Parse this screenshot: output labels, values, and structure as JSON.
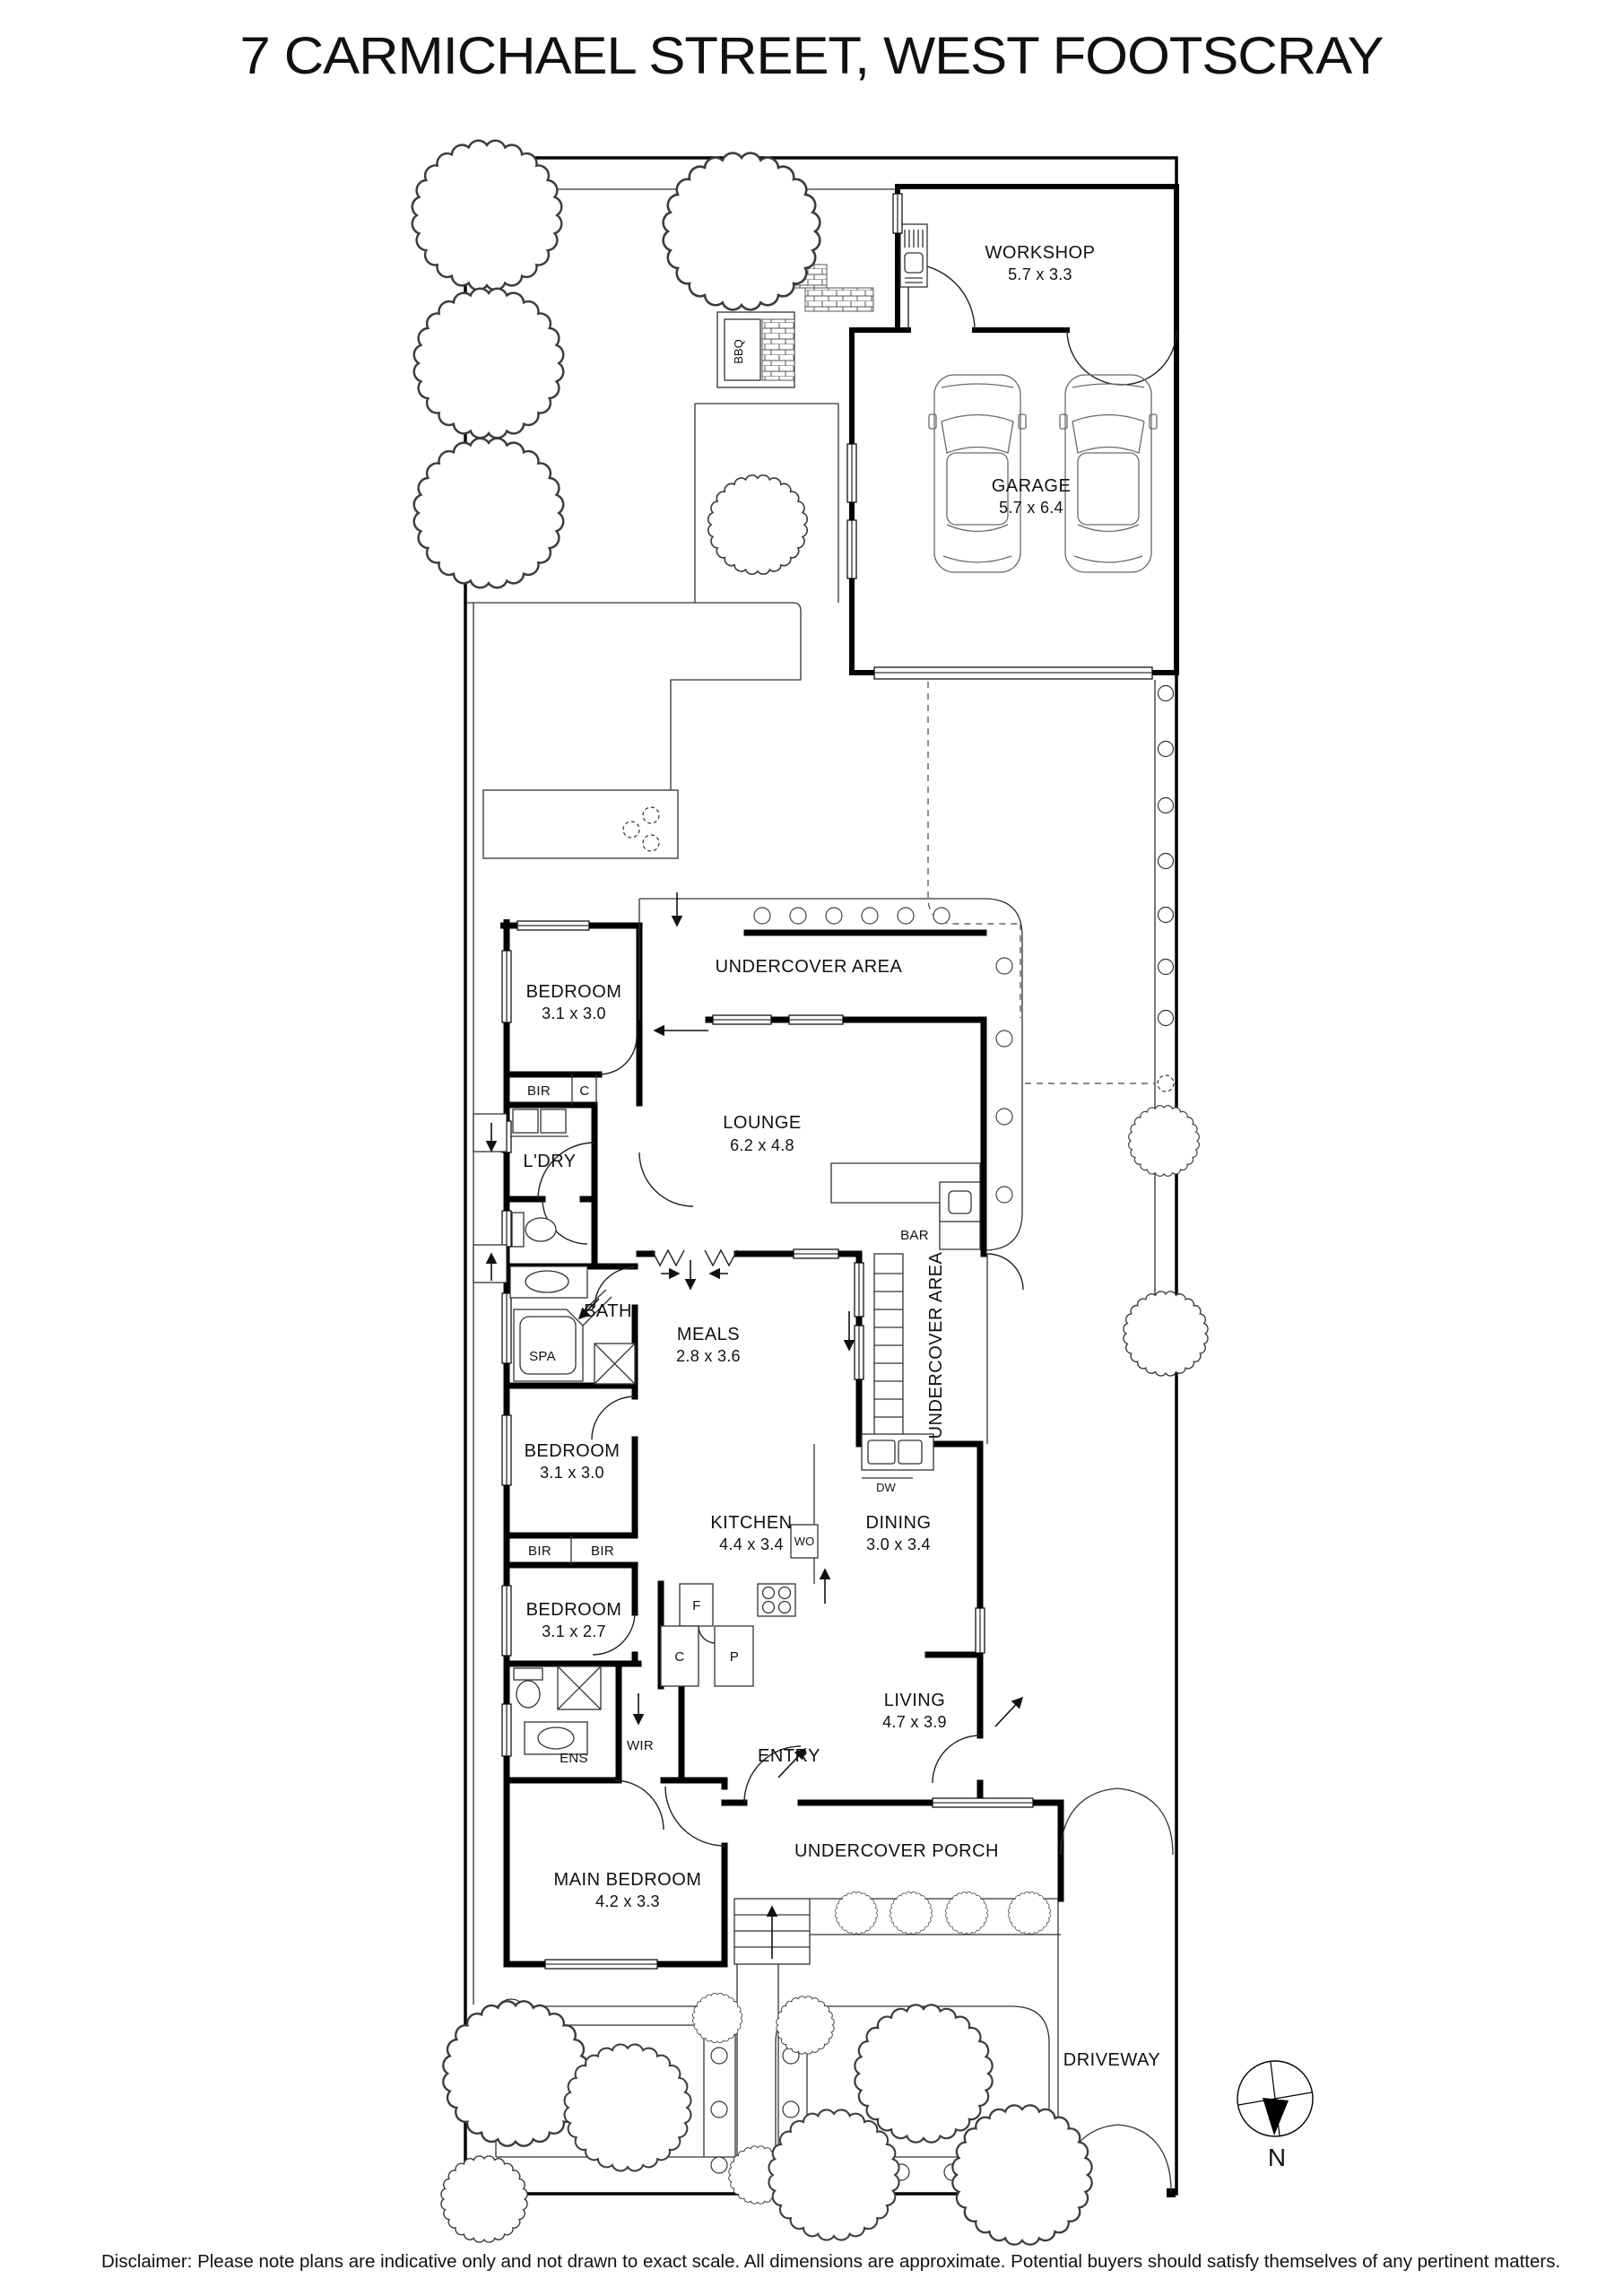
{
  "title": "7 CARMICHAEL STREET, WEST FOOTSCRAY",
  "disclaimer": "Disclaimer: Please note plans are indicative only and not drawn to exact scale. All dimensions are approximate. Potential buyers should satisfy themselves of any pertinent matters.",
  "compass": {
    "north_label": "N"
  },
  "rooms": {
    "workshop": {
      "name": "WORKSHOP",
      "dims": "5.7 x 3.3"
    },
    "garage": {
      "name": "GARAGE",
      "dims": "5.7 x 6.4"
    },
    "undercover_top": {
      "name": "UNDERCOVER AREA"
    },
    "undercover_side": {
      "name": "UNDERCOVER AREA"
    },
    "bedroom_rear": {
      "name": "BEDROOM",
      "dims": "3.1 x 3.0"
    },
    "lounge": {
      "name": "LOUNGE",
      "dims": "6.2 x 4.8"
    },
    "laundry": {
      "name": "L'DRY"
    },
    "bath": {
      "name": "BATH"
    },
    "spa": {
      "name": "SPA"
    },
    "bar": {
      "name": "BAR"
    },
    "meals": {
      "name": "MEALS",
      "dims": "2.8 x 3.6"
    },
    "bedroom_mid": {
      "name": "BEDROOM",
      "dims": "3.1 x 3.0"
    },
    "bedroom_front": {
      "name": "BEDROOM",
      "dims": "3.1 x 2.7"
    },
    "kitchen": {
      "name": "KITCHEN",
      "dims": "4.4 x 3.4"
    },
    "dining": {
      "name": "DINING",
      "dims": "3.0 x 3.4"
    },
    "living": {
      "name": "LIVING",
      "dims": "4.7 x 3.9"
    },
    "ens": {
      "name": "ENS"
    },
    "wir": {
      "name": "WIR"
    },
    "entry": {
      "name": "ENTRY"
    },
    "main_bedroom": {
      "name": "MAIN BEDROOM",
      "dims": "4.2 x 3.3"
    },
    "undercover_porch": {
      "name": "UNDERCOVER PORCH"
    },
    "driveway": {
      "name": "DRIVEWAY"
    },
    "bbq": {
      "name": "BBQ"
    }
  },
  "fixtures": {
    "bir": "BIR",
    "c": "C",
    "dw": "DW",
    "wo": "WO",
    "f": "F",
    "p": "P"
  }
}
